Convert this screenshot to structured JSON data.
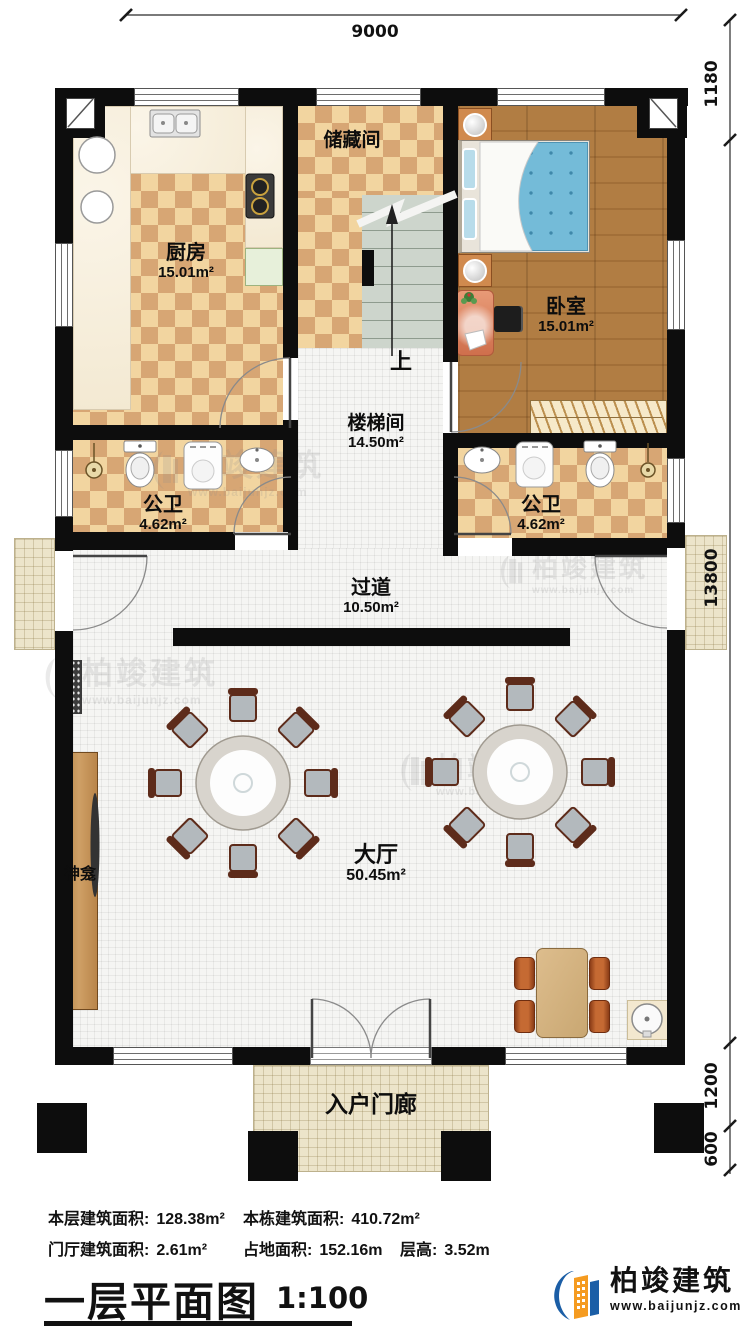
{
  "dimensions": {
    "top": "9000",
    "right_top": "1180",
    "right_middle": "13800",
    "right_lower": "1200",
    "right_bottom": "600"
  },
  "rooms": {
    "kitchen": {
      "name": "厨房",
      "area": "15.01m²"
    },
    "storage": {
      "name": "储藏间"
    },
    "bedroom": {
      "name": "卧室",
      "area": "15.01m²"
    },
    "stairwell": {
      "name": "楼梯间",
      "area": "14.50m²"
    },
    "bath_left": {
      "name": "公卫",
      "area": "4.62m²"
    },
    "bath_right": {
      "name": "公卫",
      "area": "4.62m²"
    },
    "corridor": {
      "name": "过道",
      "area": "10.50m²"
    },
    "hall": {
      "name": "大厅",
      "area": "50.45m²"
    },
    "porch": {
      "name": "入户门廊"
    },
    "shrine": {
      "name": "神龛"
    },
    "stairs_up": "上"
  },
  "stats": {
    "floor_area_label": "本层建筑面积:",
    "floor_area_value": "128.38m²",
    "building_area_label": "本栋建筑面积:",
    "building_area_value": "410.72m²",
    "porch_area_label": "门厅建筑面积:",
    "porch_area_value": "2.61m²",
    "land_area_label": "占地面积:",
    "land_area_value": "152.16m",
    "height_label": "层高:",
    "height_value": "3.52m"
  },
  "title": {
    "text": "一层平面图",
    "scale": "1:100"
  },
  "brand": {
    "name": "柏竣建筑",
    "url": "www.baijunjz.com"
  },
  "watermark": {
    "name": "柏竣建筑",
    "url": "www.baijunjz.com"
  },
  "colors": {
    "wall": "#0d0d0d",
    "checker_light": "#f2d5a0",
    "checker_dark": "#d7a674",
    "wood_floor": "#ad7a40",
    "bed_quilt": "#74bbd8",
    "stair": "#cdd5cc",
    "logo_blue": "#1b5ea6",
    "logo_orange": "#f59b20"
  }
}
